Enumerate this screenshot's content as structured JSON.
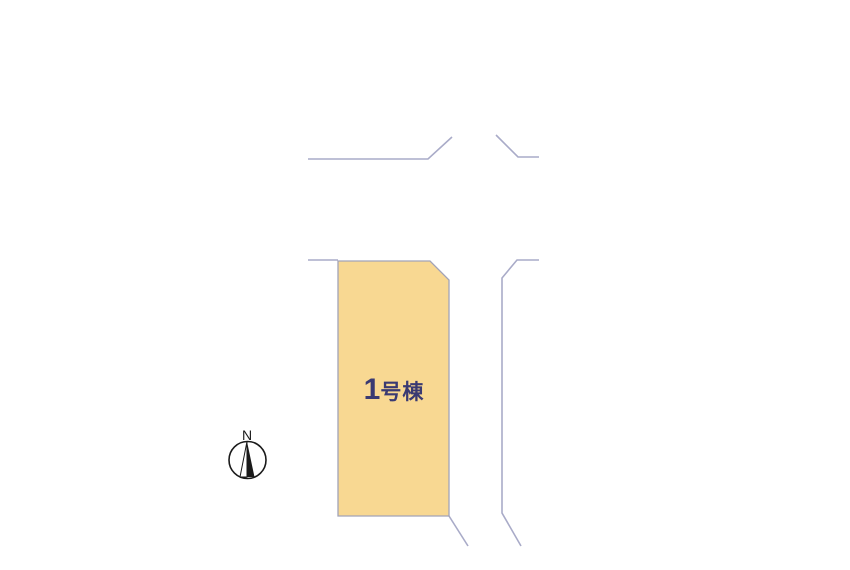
{
  "plan": {
    "background_color": "#FFFFFF",
    "road_line_color": "#A9ABC8",
    "lot": {
      "number": "1",
      "suffix": "号棟",
      "fill_color": "#F8D892",
      "border_color": "#A2A3B8",
      "label_color": "#3A3A72"
    },
    "compass": {
      "north_label": "N",
      "color": "#1A1A1A"
    }
  }
}
